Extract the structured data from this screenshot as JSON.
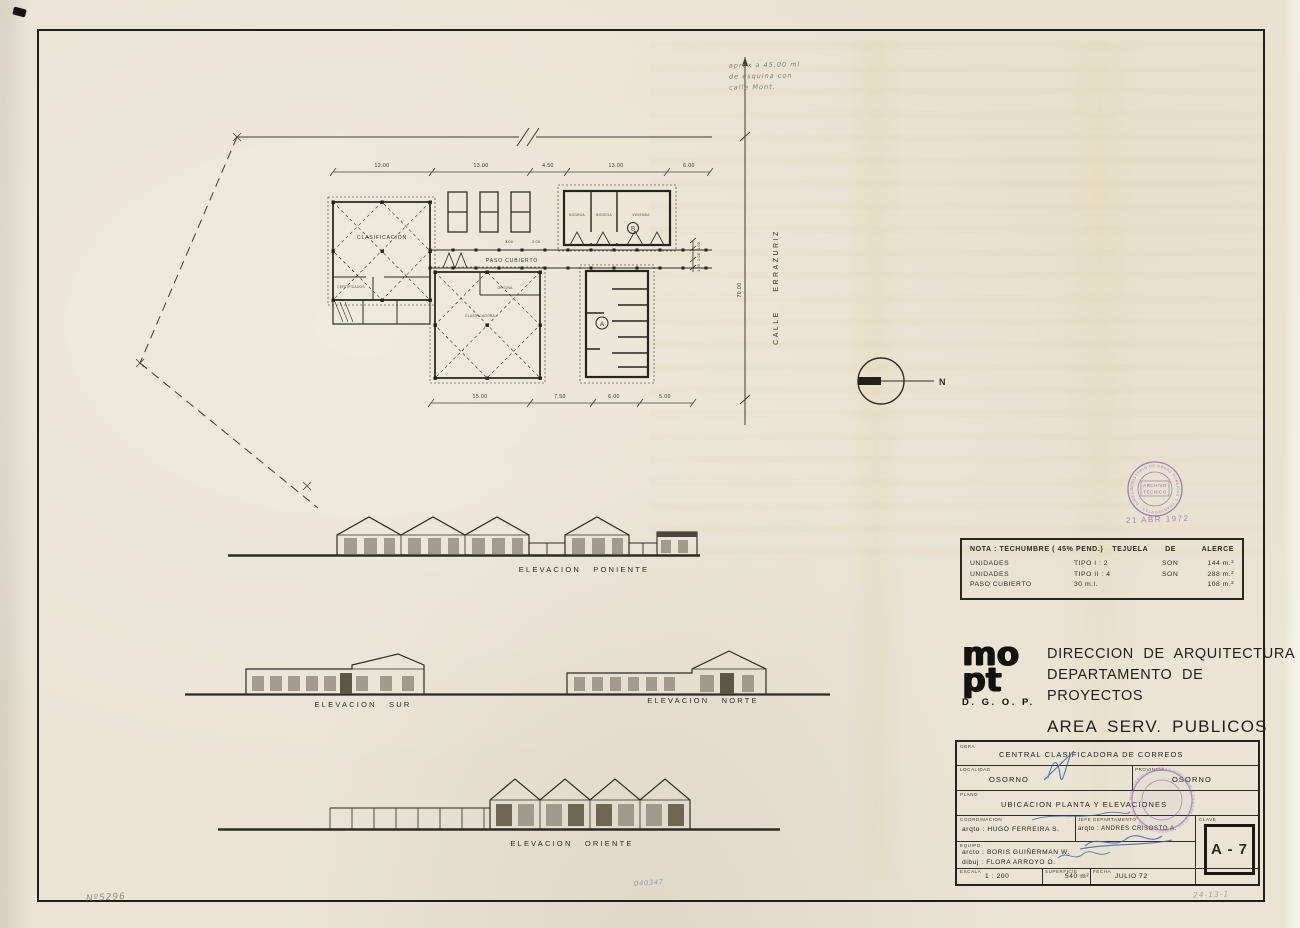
{
  "site": {
    "note_line1": "aprox a 45.00 ml",
    "note_line2": "de esquina con",
    "note_line3": "calle Mont.",
    "street_name": "CALLE ERRAZURIZ",
    "north_label": "N"
  },
  "plan": {
    "dims_top": [
      "12.00",
      "13.00",
      "4.50",
      "13.00",
      "6.00"
    ],
    "dims_bottom": [
      "15.00",
      "7.50",
      "6.00",
      "5.00"
    ],
    "dim_right": "70.00",
    "dims_small": [
      "3.00",
      "2.00",
      "1.00",
      "2.00",
      "1.00"
    ],
    "rooms": {
      "clasificacion": "CLASIFICACION",
      "certificados": "CERTIFICADOS",
      "oficina": "OFICINA",
      "clasificadora": "CLASIFICADORA",
      "paso_cubierto": "PASO CUBIERTO",
      "bodega1": "BODEGA",
      "bodega2": "BODEGA",
      "bodega3": "VIVIENDA",
      "unit_a": "A",
      "unit_b": "B"
    }
  },
  "elevations": {
    "poniente": "ELEVACION PONIENTE",
    "sur": "ELEVACION SUR",
    "norte": "ELEVACION NORTE",
    "oriente": "ELEVACION ORIENTE"
  },
  "nota": {
    "head_c1": "NOTA :  TECHUMBRE ( 45% PEND.)",
    "head_c2": "TEJUELA",
    "head_c3": "DE",
    "head_c4": "ALERCE",
    "rows": [
      {
        "name": "UNIDADES",
        "tipo": "TIPO  I  :  2",
        "son": "SON",
        "area": "144 m.²"
      },
      {
        "name": "UNIDADES",
        "tipo": "TIPO  II  :  4",
        "son": "SON",
        "area": "288 m.²"
      },
      {
        "name": "PASO  CUBIERTO",
        "tipo": "30 m.l.",
        "son": "",
        "area": "108 m.²"
      }
    ]
  },
  "agency": {
    "logo_line1": "mo",
    "logo_line2": "pt",
    "dgop": "D. G. O. P.",
    "line1": "DIRECCION  DE  ARQUITECTURA",
    "line2": "DEPARTAMENTO  DE  PROYECTOS",
    "line3": "AREA   SERV.  PUBLICOS"
  },
  "title_block": {
    "obra_label": "OBRA",
    "obra": "CENTRAL   CLASIFICADORA   DE   CORREOS",
    "localidad_label": "LOCALIDAD",
    "localidad": "OSORNO",
    "provincia_label": "PROVINCIA",
    "provincia": "OSORNO",
    "plano_label": "PLANO",
    "plano": "UBICACION   PLANTA   Y   ELEVACIONES",
    "coordinacion_label": "COORDINACION",
    "coordinacion": "arqto :  HUGO  FERREIRA  S.",
    "jefe_label": "JEFE DEPARTAMENTO",
    "jefe": "arqto : ANDRES  CRISOSTO  A.",
    "clave_label": "CLAVE",
    "clave": "A - 7",
    "equipo_label": "EQUIPO",
    "equipo_line1": "arcto :  BORIS  GUIÑERMAN  W.",
    "equipo_line2": "dibuj :  FLORA  ARROYO  O.",
    "escala_label": "ESCALA",
    "escala": "1 : 200",
    "superficie_label": "SUPERFICIE",
    "superficie": "540 m²",
    "fecha_label": "FECHA",
    "fecha": "JULIO  72"
  },
  "stamps": {
    "ring_text": "MINISTERIO DE OBRAS PUBLICAS Y TRANSPORTES · DIRECCION DE ARQUITECTURA ·",
    "center_line1": "ARCHIVO",
    "center_line2": "TECNICO",
    "date_stamp": "21 ABR 1972"
  },
  "pencil_notes": {
    "bottom_left": "Nº5296",
    "bottom_center": "040347",
    "bottom_right": "24-13-1"
  }
}
